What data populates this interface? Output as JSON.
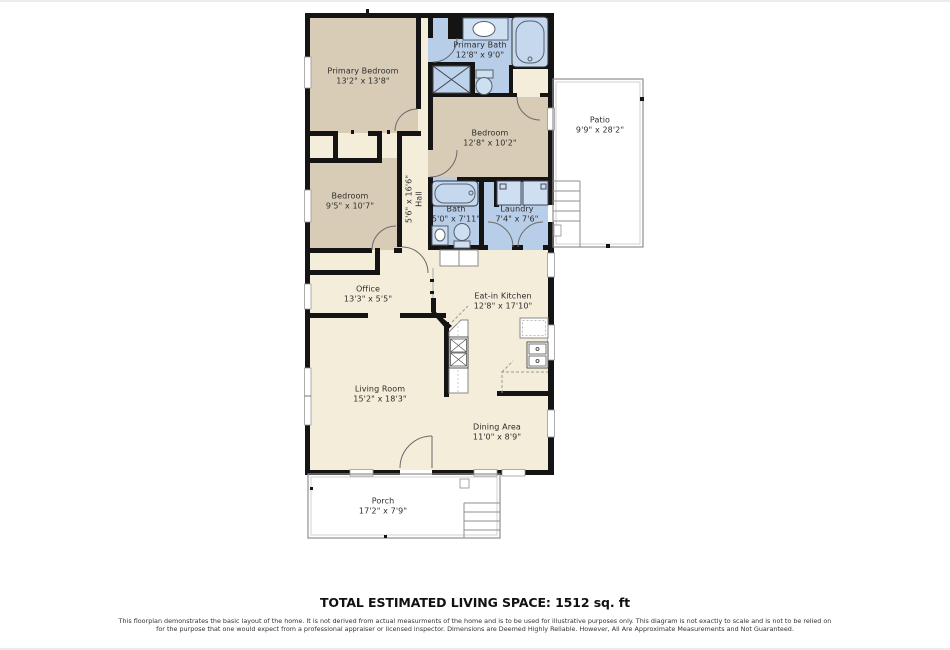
{
  "page": {
    "total_label": "TOTAL ESTIMATED LIVING SPACE: 1512 sq. ft",
    "disclaimer": "This floorplan demonstrates the basic layout of the home. It is not derived from actual measurments of the home and is to be used for illustrative purposes only. This diagram is not exactly to scale and is not to be relied on for the purpose that one would expect from a professional appraiser or licensed inspector. Dimensions are Deemed Highly Reliable. However, All Are Approximate Measurements and Not Guaranteed."
  },
  "colors": {
    "wall": "#141414",
    "interior_cream": "#f3edda",
    "bedroom_tan": "#d8ccb6",
    "bath_blue": "#b7cde8",
    "fixture_blue": "#cfdff2",
    "outline_gray": "#8f8f8f"
  },
  "rooms": [
    {
      "name": "Primary Bedroom",
      "dims": "13'2\" x 13'8\""
    },
    {
      "name": "Primary Bath",
      "dims": "12'8\" x 9'0\""
    },
    {
      "name": "Bedroom",
      "dims": "12'8\" x 10'2\""
    },
    {
      "name": "Bedroom",
      "dims": "9'5\" x 10'7\""
    },
    {
      "name": "Bath",
      "dims": "5'0\" x 7'11\""
    },
    {
      "name": "Laundry",
      "dims": "7'4\" x 7'6\""
    },
    {
      "name": "Hall",
      "dims": "5'6\" x 16'6\""
    },
    {
      "name": "Office",
      "dims": "13'3\" x 5'5\""
    },
    {
      "name": "Eat-in Kitchen",
      "dims": "12'8\" x 17'10\""
    },
    {
      "name": "Living Room",
      "dims": "15'2\" x 18'3\""
    },
    {
      "name": "Dining Area",
      "dims": "11'0\" x 8'9\""
    },
    {
      "name": "Patio",
      "dims": "9'9\" x 28'2\""
    },
    {
      "name": "Porch",
      "dims": "17'2\" x 7'9\""
    }
  ]
}
